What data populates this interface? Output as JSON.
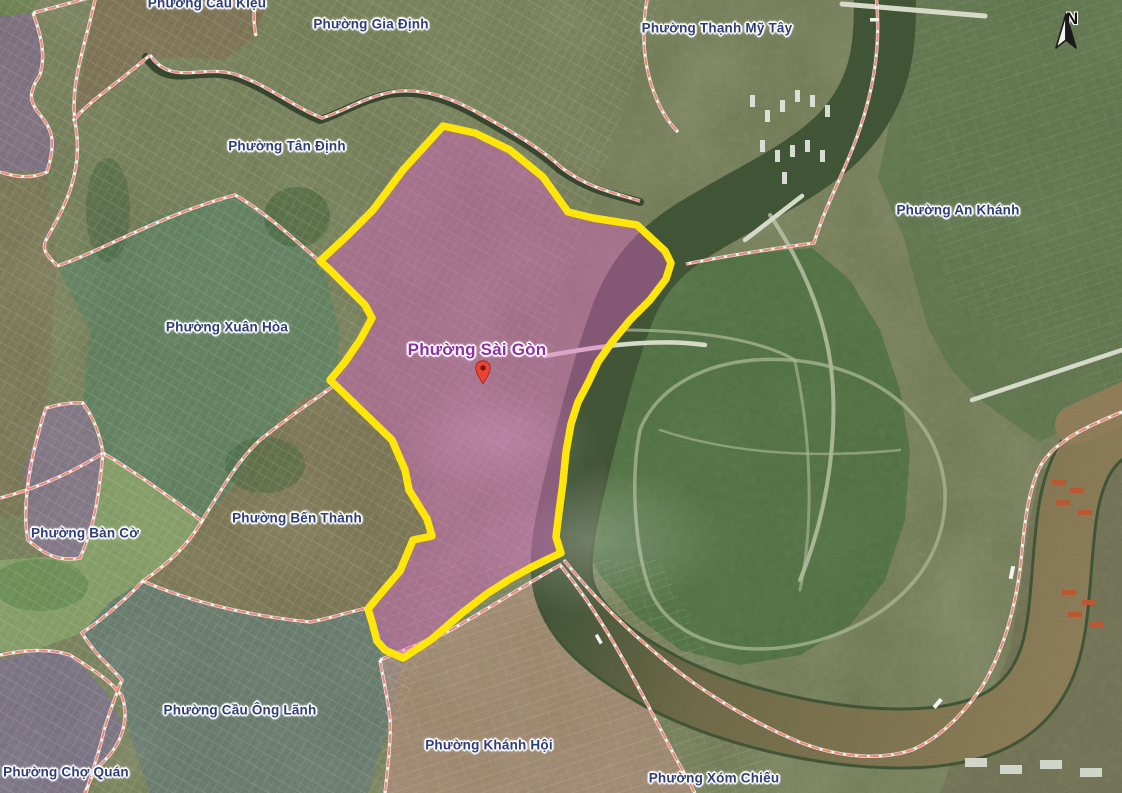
{
  "map": {
    "description": "Satellite map of Ho Chi Minh City wards with selected ward highlighted",
    "selected_ward": {
      "name": "Phường Sài Gòn",
      "label_color": "#8e2fa6",
      "boundary_color": "#ffe60a",
      "fill_color": "#e35ccb",
      "marker": "red-pin",
      "x": 477,
      "y": 350
    },
    "ward_labels": [
      {
        "id": "cau-kieu",
        "name": "Phường Cầu Kiệu",
        "x": 207,
        "y": 3
      },
      {
        "id": "gia-dinh",
        "name": "Phường Gia Định",
        "x": 371,
        "y": 24
      },
      {
        "id": "thanh-my-tay",
        "name": "Phường Thạnh Mỹ Tây",
        "x": 717,
        "y": 28
      },
      {
        "id": "tan-dinh",
        "name": "Phường Tân Định",
        "x": 287,
        "y": 146
      },
      {
        "id": "an-khanh",
        "name": "Phường An Khánh",
        "x": 958,
        "y": 210
      },
      {
        "id": "xuan-hoa",
        "name": "Phường Xuân Hòa",
        "x": 227,
        "y": 327
      },
      {
        "id": "ben-thanh",
        "name": "Phường Bến Thành",
        "x": 297,
        "y": 518
      },
      {
        "id": "ban-co",
        "name": "Phường Bàn Cờ",
        "x": 85,
        "y": 533
      },
      {
        "id": "cau-ong-lanh",
        "name": "Phường Cầu Ông Lãnh",
        "x": 240,
        "y": 710
      },
      {
        "id": "khanh-hoi",
        "name": "Phường Khánh Hội",
        "x": 489,
        "y": 745
      },
      {
        "id": "cho-quan",
        "name": "Phường Chợ Quán",
        "x": 66,
        "y": 772
      },
      {
        "id": "xom-chieu",
        "name": "Phường Xóm Chiếu",
        "x": 714,
        "y": 778
      }
    ],
    "compass": {
      "label": "N"
    },
    "colors": {
      "boundary_line": "#ee8372",
      "label_text": "#2e3d78",
      "river_green": "#3e5134",
      "river_brown": "#8a7856",
      "base_land": "#6b7450"
    }
  }
}
